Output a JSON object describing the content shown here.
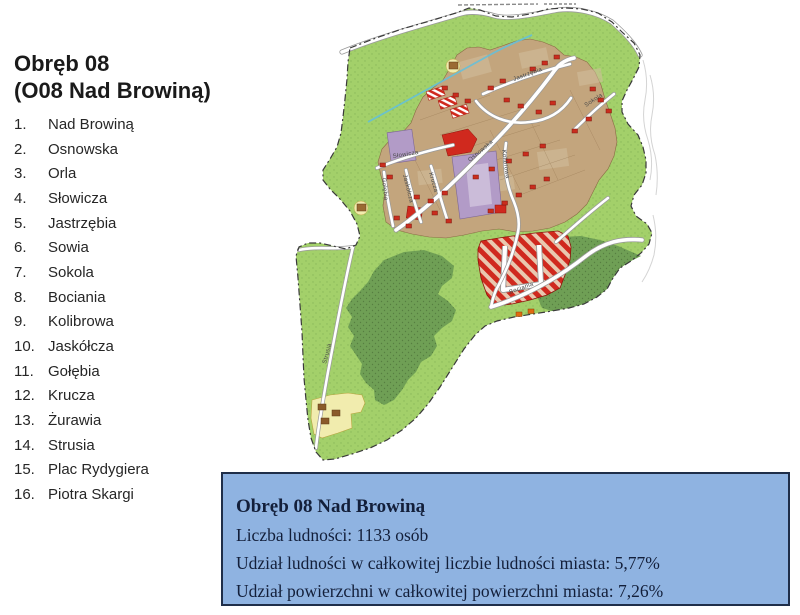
{
  "header": {
    "title_line1": "Obręb 08",
    "title_line2": "(O08 Nad Browiną)"
  },
  "streets": [
    {
      "num": "1.",
      "name": "Nad Browiną"
    },
    {
      "num": "2.",
      "name": "Osnowska"
    },
    {
      "num": "3.",
      "name": "Orla"
    },
    {
      "num": "4.",
      "name": "Słowicza"
    },
    {
      "num": "5.",
      "name": "Jastrzębia"
    },
    {
      "num": "6.",
      "name": "Sowia"
    },
    {
      "num": "7.",
      "name": "Sokola"
    },
    {
      "num": "8.",
      "name": "Bociania"
    },
    {
      "num": "9.",
      "name": "Kolibrowa"
    },
    {
      "num": "10.",
      "name": "Jaskółcza"
    },
    {
      "num": "11.",
      "name": "Gołębia"
    },
    {
      "num": "12.",
      "name": "Krucza"
    },
    {
      "num": "13.",
      "name": "Żurawia"
    },
    {
      "num": "14.",
      "name": "Strusia"
    },
    {
      "num": "15.",
      "name": "Plac Rydygiera"
    },
    {
      "num": "16.",
      "name": "Piotra Skargi"
    }
  ],
  "info_box": {
    "title": "Obręb 08 Nad Browiną",
    "line_population": "Liczba ludności: 1133 osób",
    "line_population_share": "Udział ludności w całkowitej liczbie ludności miasta: 5,77%",
    "line_area_share": "Udział powierzchni w całkowitej powierzchni miasta: 7,26%",
    "background": "#8fb3e1",
    "border_color": "#1f2e49",
    "text_color": "#131f3a"
  },
  "map": {
    "street_labels": [
      {
        "text": "Osnowska"
      },
      {
        "text": "Słowicza"
      },
      {
        "text": "Jastrzębia"
      },
      {
        "text": "Sokola"
      },
      {
        "text": "Kolibrowa"
      },
      {
        "text": "Gołębia"
      },
      {
        "text": "Jaskółcza"
      },
      {
        "text": "Krucza"
      },
      {
        "text": "Bociania"
      },
      {
        "text": "Strusia"
      }
    ],
    "zone_colors": {
      "open_green": "#a3d06a",
      "forest_green": "#6f9f55",
      "residential_tan": "#c3a57d",
      "services_purple": "#b29bc7",
      "development_red": "#d0291e",
      "farm_yellow": "#f1ecae",
      "stream_blue": "#62c0dd"
    }
  }
}
